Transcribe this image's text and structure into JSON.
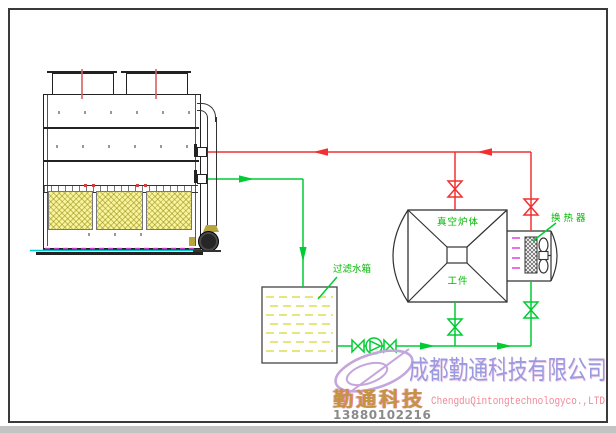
{
  "labels": {
    "filter_tank": "过滤水箱",
    "furnace_body": "真空炉体",
    "workpiece": "工件",
    "heat_exchanger": "换 热 器"
  },
  "company": {
    "name_cn": "成都勤通科技有限公司",
    "name_en": "ChengduQintongtechnologyco.,LTD",
    "logo_text_cn": "勤通科技",
    "phone": "13880102216"
  },
  "colors": {
    "hot_line": "#f23030",
    "cold_line": "#00cc33",
    "basin_line": "#00cccc",
    "accent_dash": "#e040e0",
    "label_green": "#00b800",
    "fill_yellow": "#f7f49e",
    "logo_purple": "#c4a6dc",
    "company_cn": "#9a9ae0",
    "company_en": "#f08898",
    "logo_text_color": "#c49540",
    "phone_gray": "#8a8a8a"
  }
}
